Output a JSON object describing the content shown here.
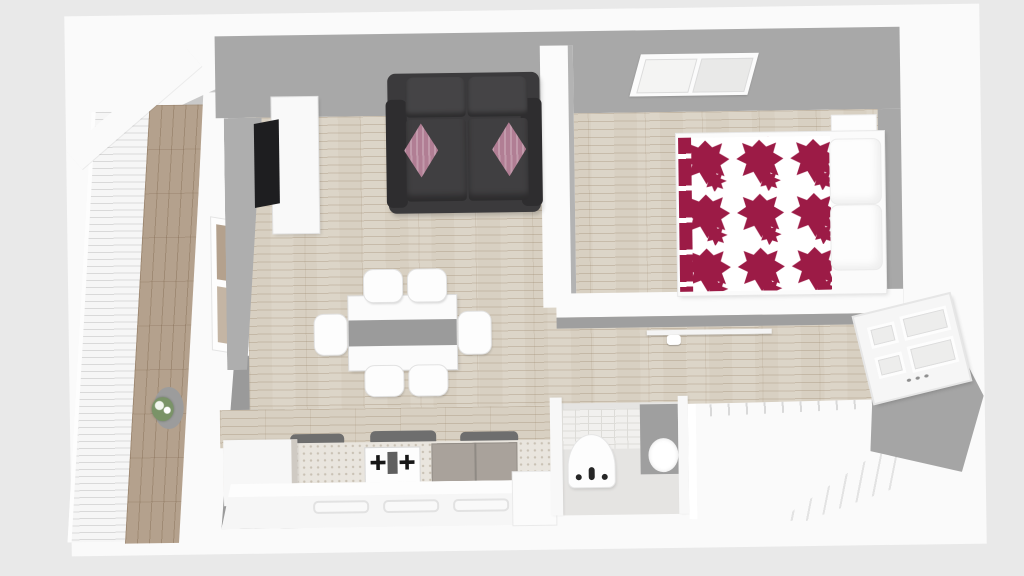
{
  "scene": {
    "kind": "floorplan-3d-top-view",
    "rooms": [
      {
        "name": "balcony",
        "items": [
          "slatted-railing",
          "wood-deck",
          "potted-plant"
        ]
      },
      {
        "name": "living-room",
        "items": [
          "tv",
          "tv-stand",
          "sofa",
          "throw-pillow-left",
          "throw-pillow-right",
          "window",
          "dining-table",
          "table-runner",
          "chair-1",
          "chair-2",
          "chair-3",
          "chair-4",
          "chair-5",
          "chair-6"
        ]
      },
      {
        "name": "kitchen",
        "items": [
          "corner-cabinet",
          "gas-stove",
          "double-door-cabinet",
          "island-counter",
          "island-end-cabinet",
          "countertop-appliances"
        ]
      },
      {
        "name": "bedroom",
        "items": [
          "double-bed",
          "patterned-duvet",
          "pillow-top",
          "pillow-bottom",
          "nightstand",
          "skylight-window"
        ]
      },
      {
        "name": "hallway",
        "items": [
          "wall-shelf",
          "entry-door"
        ]
      },
      {
        "name": "bathroom",
        "items": [
          "pedestal-sink",
          "shower-panel",
          "wall-basin",
          "tiled-wall"
        ]
      },
      {
        "name": "staircase",
        "items": [
          "railing",
          "steps"
        ]
      }
    ]
  },
  "colors": {
    "background": "#e9e9e9",
    "wall_white": "#fafafa",
    "wall_gray": "#a8a8a8",
    "wall_gray_dark": "#9a9a9a",
    "wall_gray_light": "#c9c9c9",
    "floor_wood": "#d8d0c2",
    "floor_wood_line": "#b9ab94",
    "balcony_wood": "#b4a18d",
    "sofa_dark": "#3b3a3c",
    "sofa_darker": "#2e2d2f",
    "pillow_mauve": "#b17e94",
    "tv_black": "#1e1e20",
    "duvet_red": "#9c1b46",
    "table_runner": "#9b9b9b",
    "chair_white": "#fdfdfd",
    "counter_speckle_base": "#e9e5de",
    "counter_speckle_dot": "#c9c1b4",
    "cabinet_gray": "#a9a29b",
    "tile_base": "#f1f0ee",
    "tile_line": "#dddcd8",
    "shower_gray": "#9f9f9f",
    "bath_floor": "#e5e4e2",
    "stair_white": "#fafafa",
    "stair_line": "#e3e3e3",
    "plant_green": "#7a9367",
    "plant_pot": "#9c9c9c",
    "door_white": "#f6f6f6"
  }
}
